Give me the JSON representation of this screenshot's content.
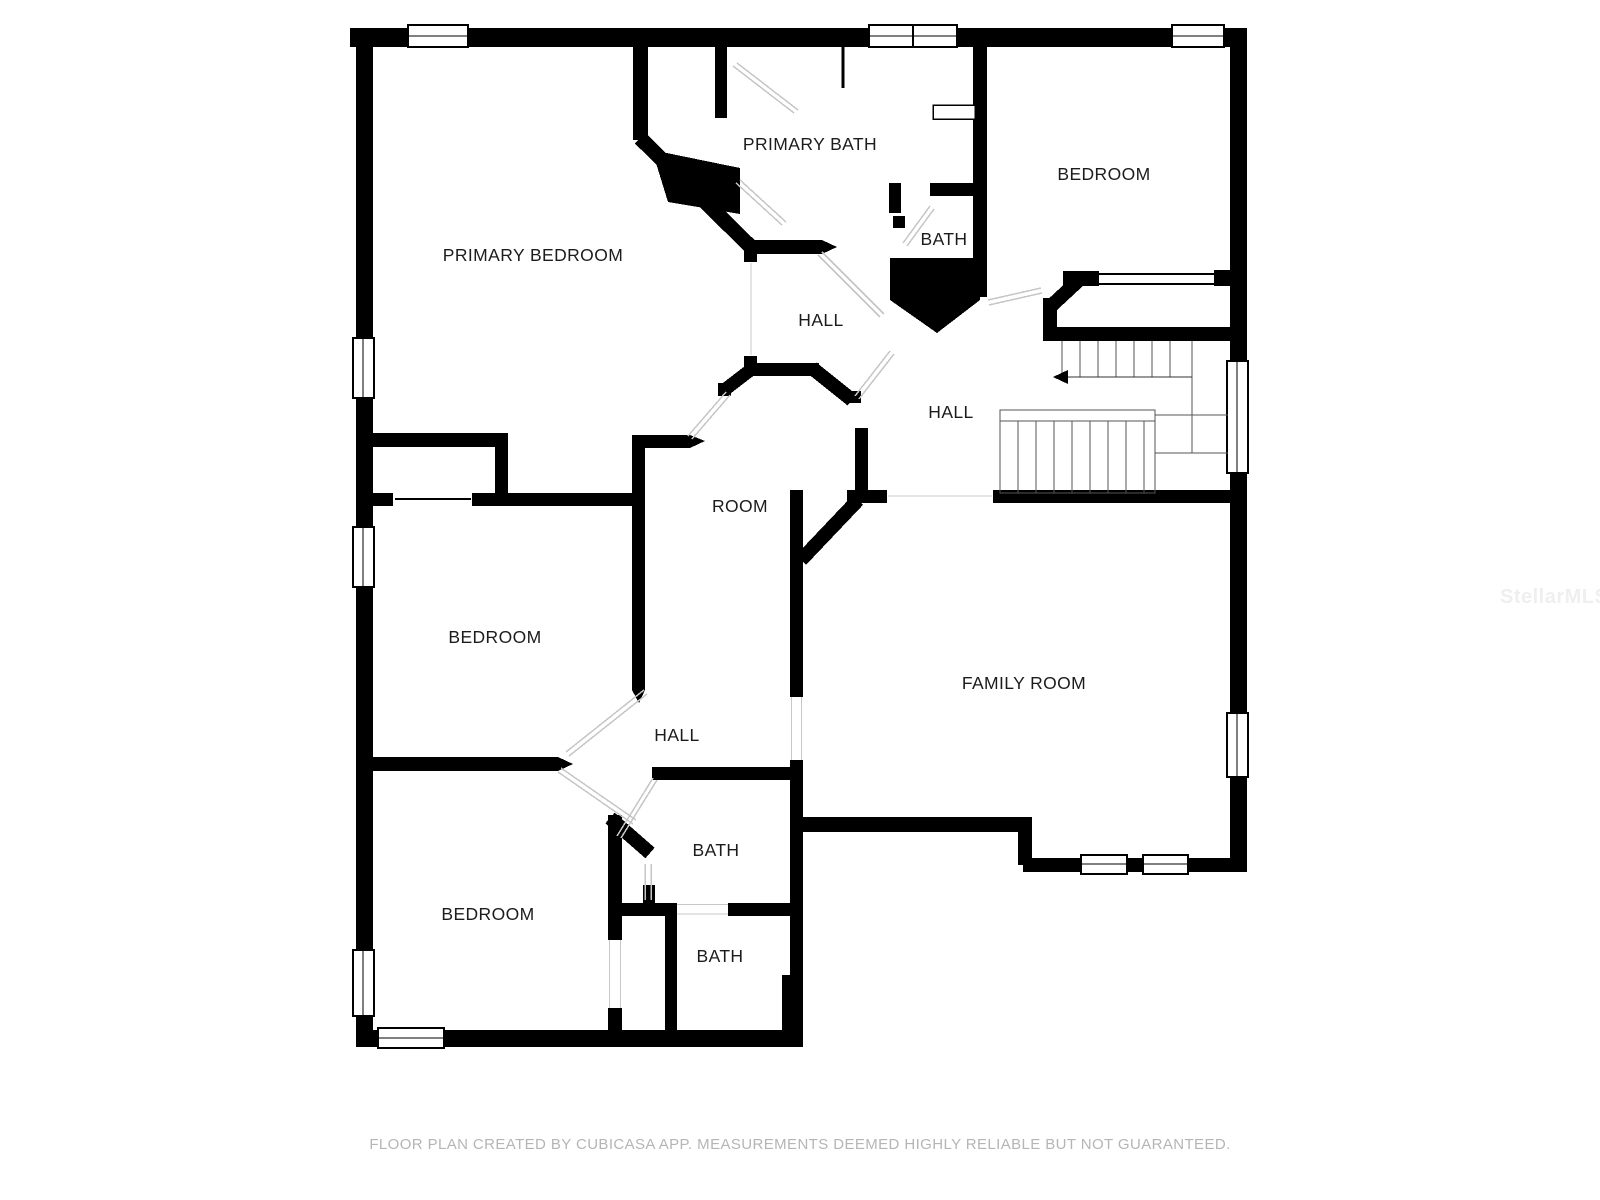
{
  "page": {
    "background": "#ffffff"
  },
  "floor_plan": {
    "wall_color": "#000000",
    "label_color": "#1c1c1c",
    "rooms": [
      {
        "id": "primary-bedroom",
        "label": "PRIMARY BEDROOM"
      },
      {
        "id": "primary-bath",
        "label": "PRIMARY BATH"
      },
      {
        "id": "bath-top",
        "label": "BATH"
      },
      {
        "id": "bedroom-top-right",
        "label": "BEDROOM"
      },
      {
        "id": "hall-center",
        "label": "HALL"
      },
      {
        "id": "hall-right",
        "label": "HALL"
      },
      {
        "id": "room",
        "label": "ROOM"
      },
      {
        "id": "bedroom-middle",
        "label": "BEDROOM"
      },
      {
        "id": "family-room",
        "label": "FAMILY ROOM"
      },
      {
        "id": "hall-lower",
        "label": "HALL"
      },
      {
        "id": "bath-middle",
        "label": "BATH"
      },
      {
        "id": "bedroom-bottom",
        "label": "BEDROOM"
      },
      {
        "id": "bath-bottom",
        "label": "BATH"
      }
    ],
    "stairs": {
      "direction_arrow": "left"
    }
  },
  "watermark": {
    "text": "StellarMLS",
    "color": "#efefef"
  },
  "footer": {
    "text": "FLOOR PLAN CREATED BY CUBICASA APP. MEASUREMENTS DEEMED HIGHLY RELIABLE BUT NOT GUARANTEED.",
    "color": "#b5b5b5"
  }
}
